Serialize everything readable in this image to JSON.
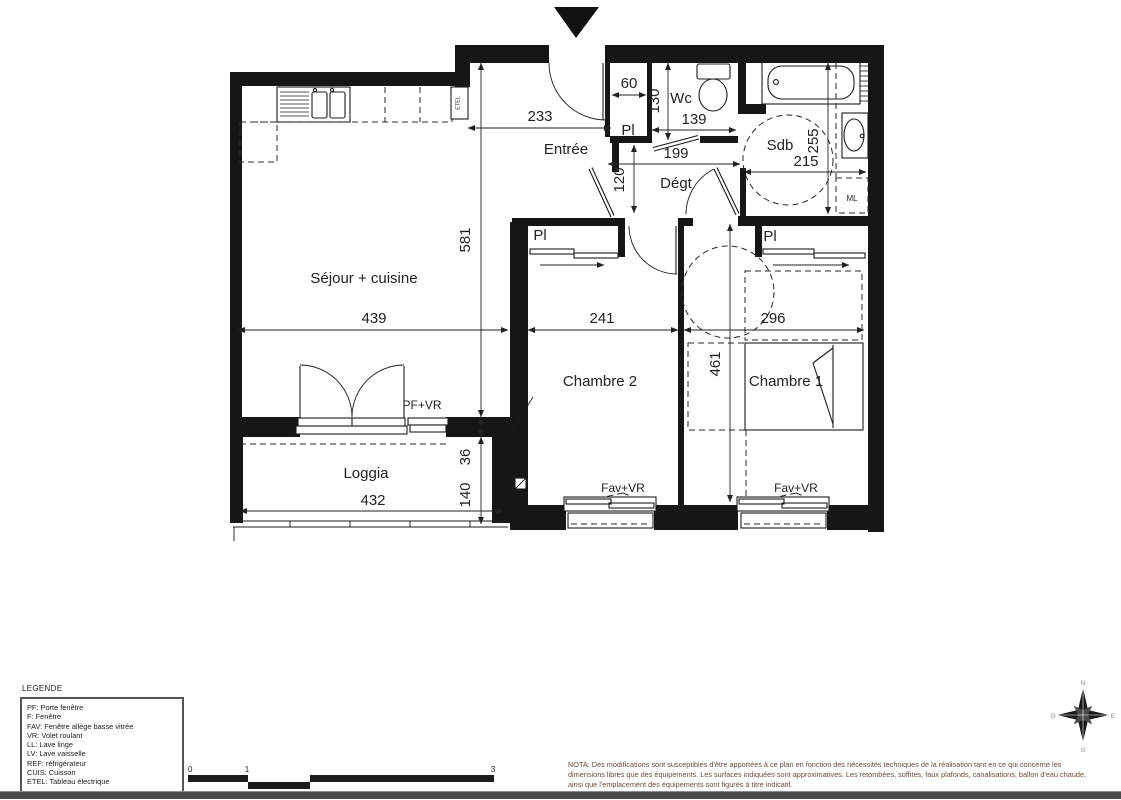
{
  "page": {
    "bg": "#ffffff",
    "ink": "#1a1a1a",
    "nota_color": "#6d4a3e"
  },
  "plan": {
    "rooms": {
      "sejour": "Séjour + cuisine",
      "entree": "Entrée",
      "wc": "Wc",
      "degt": "Dégt",
      "sdb": "Sdb",
      "chambre2": "Chambre 2",
      "chambre1": "Chambre 1",
      "loggia": "Loggia"
    },
    "labels": {
      "pl": "Pl",
      "ml": "ML",
      "etel": "ETEL",
      "pf_vr": "PF+VR",
      "fav_vr": "Fav+VR"
    },
    "dims": {
      "entree_w": "233",
      "pl_w": "60",
      "wc_h": "130",
      "wc_w": "139",
      "degt_w": "199",
      "degt_h": "120",
      "sdb_h": "255",
      "sdb_w": "215",
      "sejour_h": "581",
      "sejour_w": "439",
      "ch2_w": "241",
      "ch1_w": "296",
      "ch_h": "461",
      "loggia_w": "432",
      "loggia_h": "140",
      "wall_gap": "36"
    }
  },
  "legend": {
    "title": "LEGENDE",
    "items": [
      "PF: Porte fenêtre",
      "F: Fenêtre",
      "FAV: Fenêtre allège basse vitrée",
      "VR: Volet roulant",
      "LL: Lave linge",
      "LV: Lave vaisselle",
      "REF: réfrigérateur",
      "CUIS: Cuisson",
      "ETEL: Tableau électrique"
    ]
  },
  "scalebar": {
    "labels": [
      "0",
      "1",
      "3"
    ]
  },
  "compass": {
    "n": "N",
    "s": "S",
    "e": "E",
    "o": "O"
  },
  "nota": {
    "lines": [
      "NOTA: Des modifications sont susceptibles d'être apportées à ce plan en fonction des nécessités techniques de la réalisation tant en ce qui concerne les",
      "dimensions libres que des équipements. Les surfaces indiquées sont approximatives. Les retombées, soffites, faux plafonds, canalisations, ballon d'eau chaude,",
      "ainsi que l'emplacement des équipements sont figurés à titre indicatif."
    ]
  }
}
